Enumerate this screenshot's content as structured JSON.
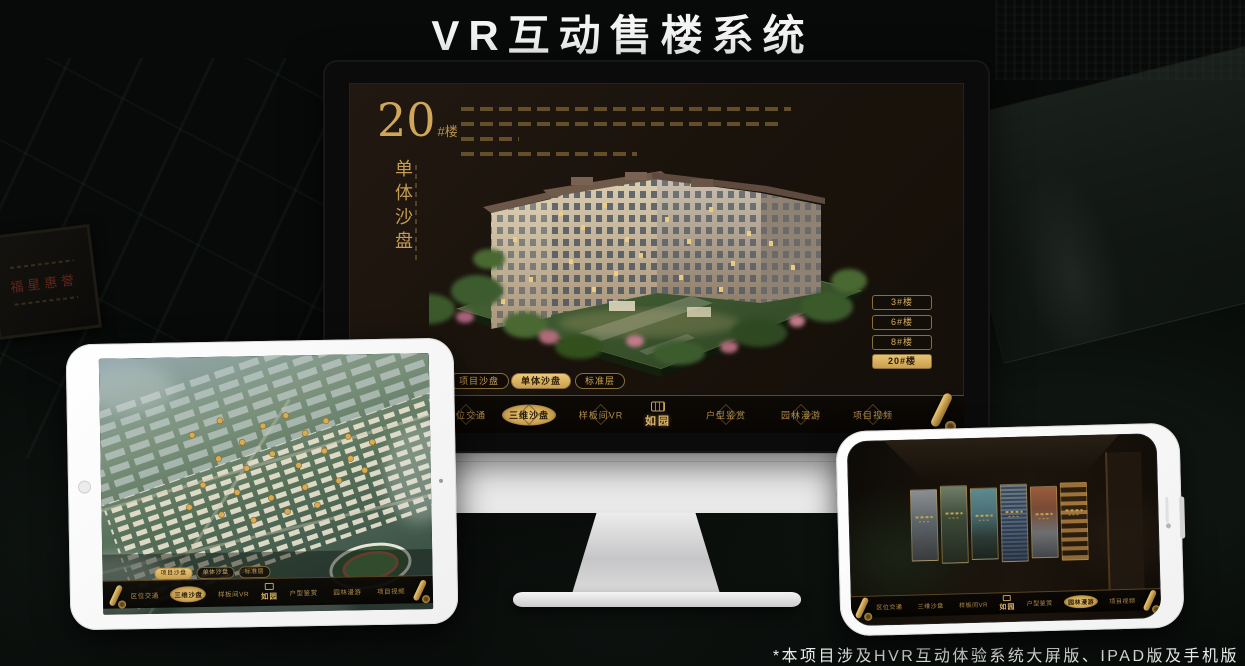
{
  "page": {
    "title": "VR互动售楼系统",
    "footnote": "*本项目涉及HVR互动体验系统大屏版、IPAD版及手机版"
  },
  "colors": {
    "gold_accent": "#d4ab5f",
    "gold_active": "#e8c273",
    "screen_brown": "#1a130c",
    "background": "#070a08",
    "device_white": "#f5f5f5"
  },
  "background": {
    "plaque_text": "福星惠誉"
  },
  "monitor": {
    "panel": {
      "big_number": "20",
      "big_suffix": "#楼",
      "vertical_title": "单体沙盘"
    },
    "building_buttons": [
      {
        "label": "3#楼",
        "active": false
      },
      {
        "label": "6#楼",
        "active": false
      },
      {
        "label": "8#楼",
        "active": false
      },
      {
        "label": "20#楼",
        "active": true
      }
    ],
    "sub_tabs": [
      {
        "label": "项目沙盘",
        "active": false
      },
      {
        "label": "单体沙盘",
        "active": true
      },
      {
        "label": "标准层",
        "active": false
      }
    ],
    "nav": {
      "logo_text": "如园",
      "items": [
        {
          "label": "区位交通",
          "active": false
        },
        {
          "label": "三维沙盘",
          "active": true
        },
        {
          "label": "样板间VR",
          "active": false
        },
        {
          "label": "户型鉴赏",
          "active": false
        },
        {
          "label": "园林漫游",
          "active": false
        },
        {
          "label": "项目视频",
          "active": false
        }
      ]
    }
  },
  "tablet": {
    "sub_tabs": [
      {
        "label": "项目沙盘",
        "active": true
      },
      {
        "label": "单体沙盘",
        "active": false
      },
      {
        "label": "标准层",
        "active": false
      }
    ],
    "nav": {
      "logo_text": "如园",
      "items": [
        {
          "label": "区位交通",
          "active": false
        },
        {
          "label": "三维沙盘",
          "active": true
        },
        {
          "label": "样板间VR",
          "active": false
        },
        {
          "label": "户型鉴赏",
          "active": false
        },
        {
          "label": "园林漫游",
          "active": false
        },
        {
          "label": "项目视频",
          "active": false
        }
      ]
    }
  },
  "phone": {
    "nav": {
      "logo_text": "如园",
      "items": [
        {
          "label": "区位交通",
          "active": false
        },
        {
          "label": "三维沙盘",
          "active": false
        },
        {
          "label": "样板间VR",
          "active": false
        },
        {
          "label": "户型鉴赏",
          "active": false
        },
        {
          "label": "园林漫游",
          "active": true
        },
        {
          "label": "项目视频",
          "active": false
        }
      ]
    }
  }
}
